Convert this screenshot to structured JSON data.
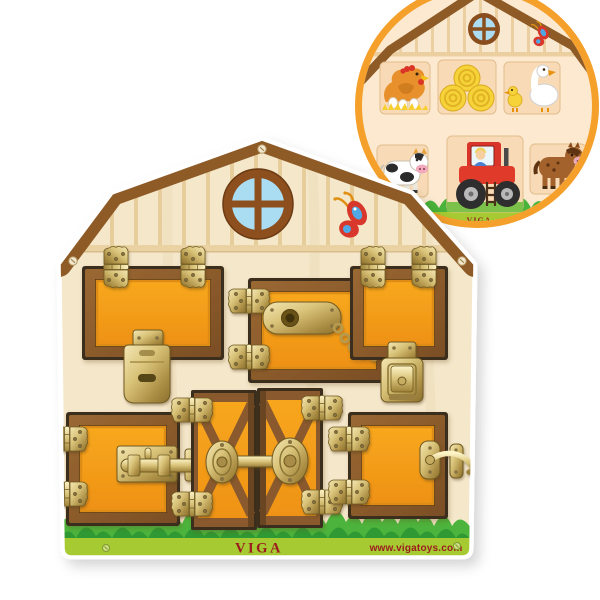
{
  "product": {
    "type": "wooden latch activity board shaped like a barn",
    "brand_label": "VIGA",
    "website": "www.vigatoys.com"
  },
  "board": {
    "brand_label": "VIGA",
    "website": "www.vigatoys.com",
    "doors": [
      {
        "position": "top-left",
        "latch": "hasp-lock",
        "hinges": "top"
      },
      {
        "position": "top-middle",
        "latch": "chain-door-guard",
        "hinges": "left"
      },
      {
        "position": "top-right",
        "latch": "case-clasp-latch",
        "hinges": "top"
      },
      {
        "position": "bottom-left",
        "latch": "barrel-bolt",
        "hinges": "left"
      },
      {
        "position": "bottom-middle-double",
        "latch": "swivel-turn-latch",
        "hinges": "outer-edges"
      },
      {
        "position": "bottom-right",
        "latch": "hook-latch",
        "hinges": "left"
      }
    ],
    "decorations": [
      "round-window",
      "butterfly",
      "grass",
      "screws"
    ]
  },
  "inset": {
    "brand_label": "VIGA",
    "shows": "same barn board with doors open",
    "animals": [
      "hen-on-nest",
      "hay-bales",
      "goose-with-gosling",
      "cow",
      "farmer-on-tractor",
      "horse"
    ]
  },
  "palette": {
    "background": "#ffffff",
    "board_wood": "#f4e7ca",
    "gable_stripe": "#e7cd9c",
    "roof_brown": "#8e5a26",
    "door_orange": "#f49d1c",
    "door_frame_brown": "#8a5a2e",
    "brass": "#cdb86e",
    "grass_green": "#42ac39",
    "strip_green": "#a6ca31",
    "brand_red": "#9c1b1f",
    "window_blue": "#aadcf2",
    "ring_orange": "#f5a02b",
    "inset_wall": "#fce9cf",
    "opening_tan": "#f8dbb6"
  }
}
